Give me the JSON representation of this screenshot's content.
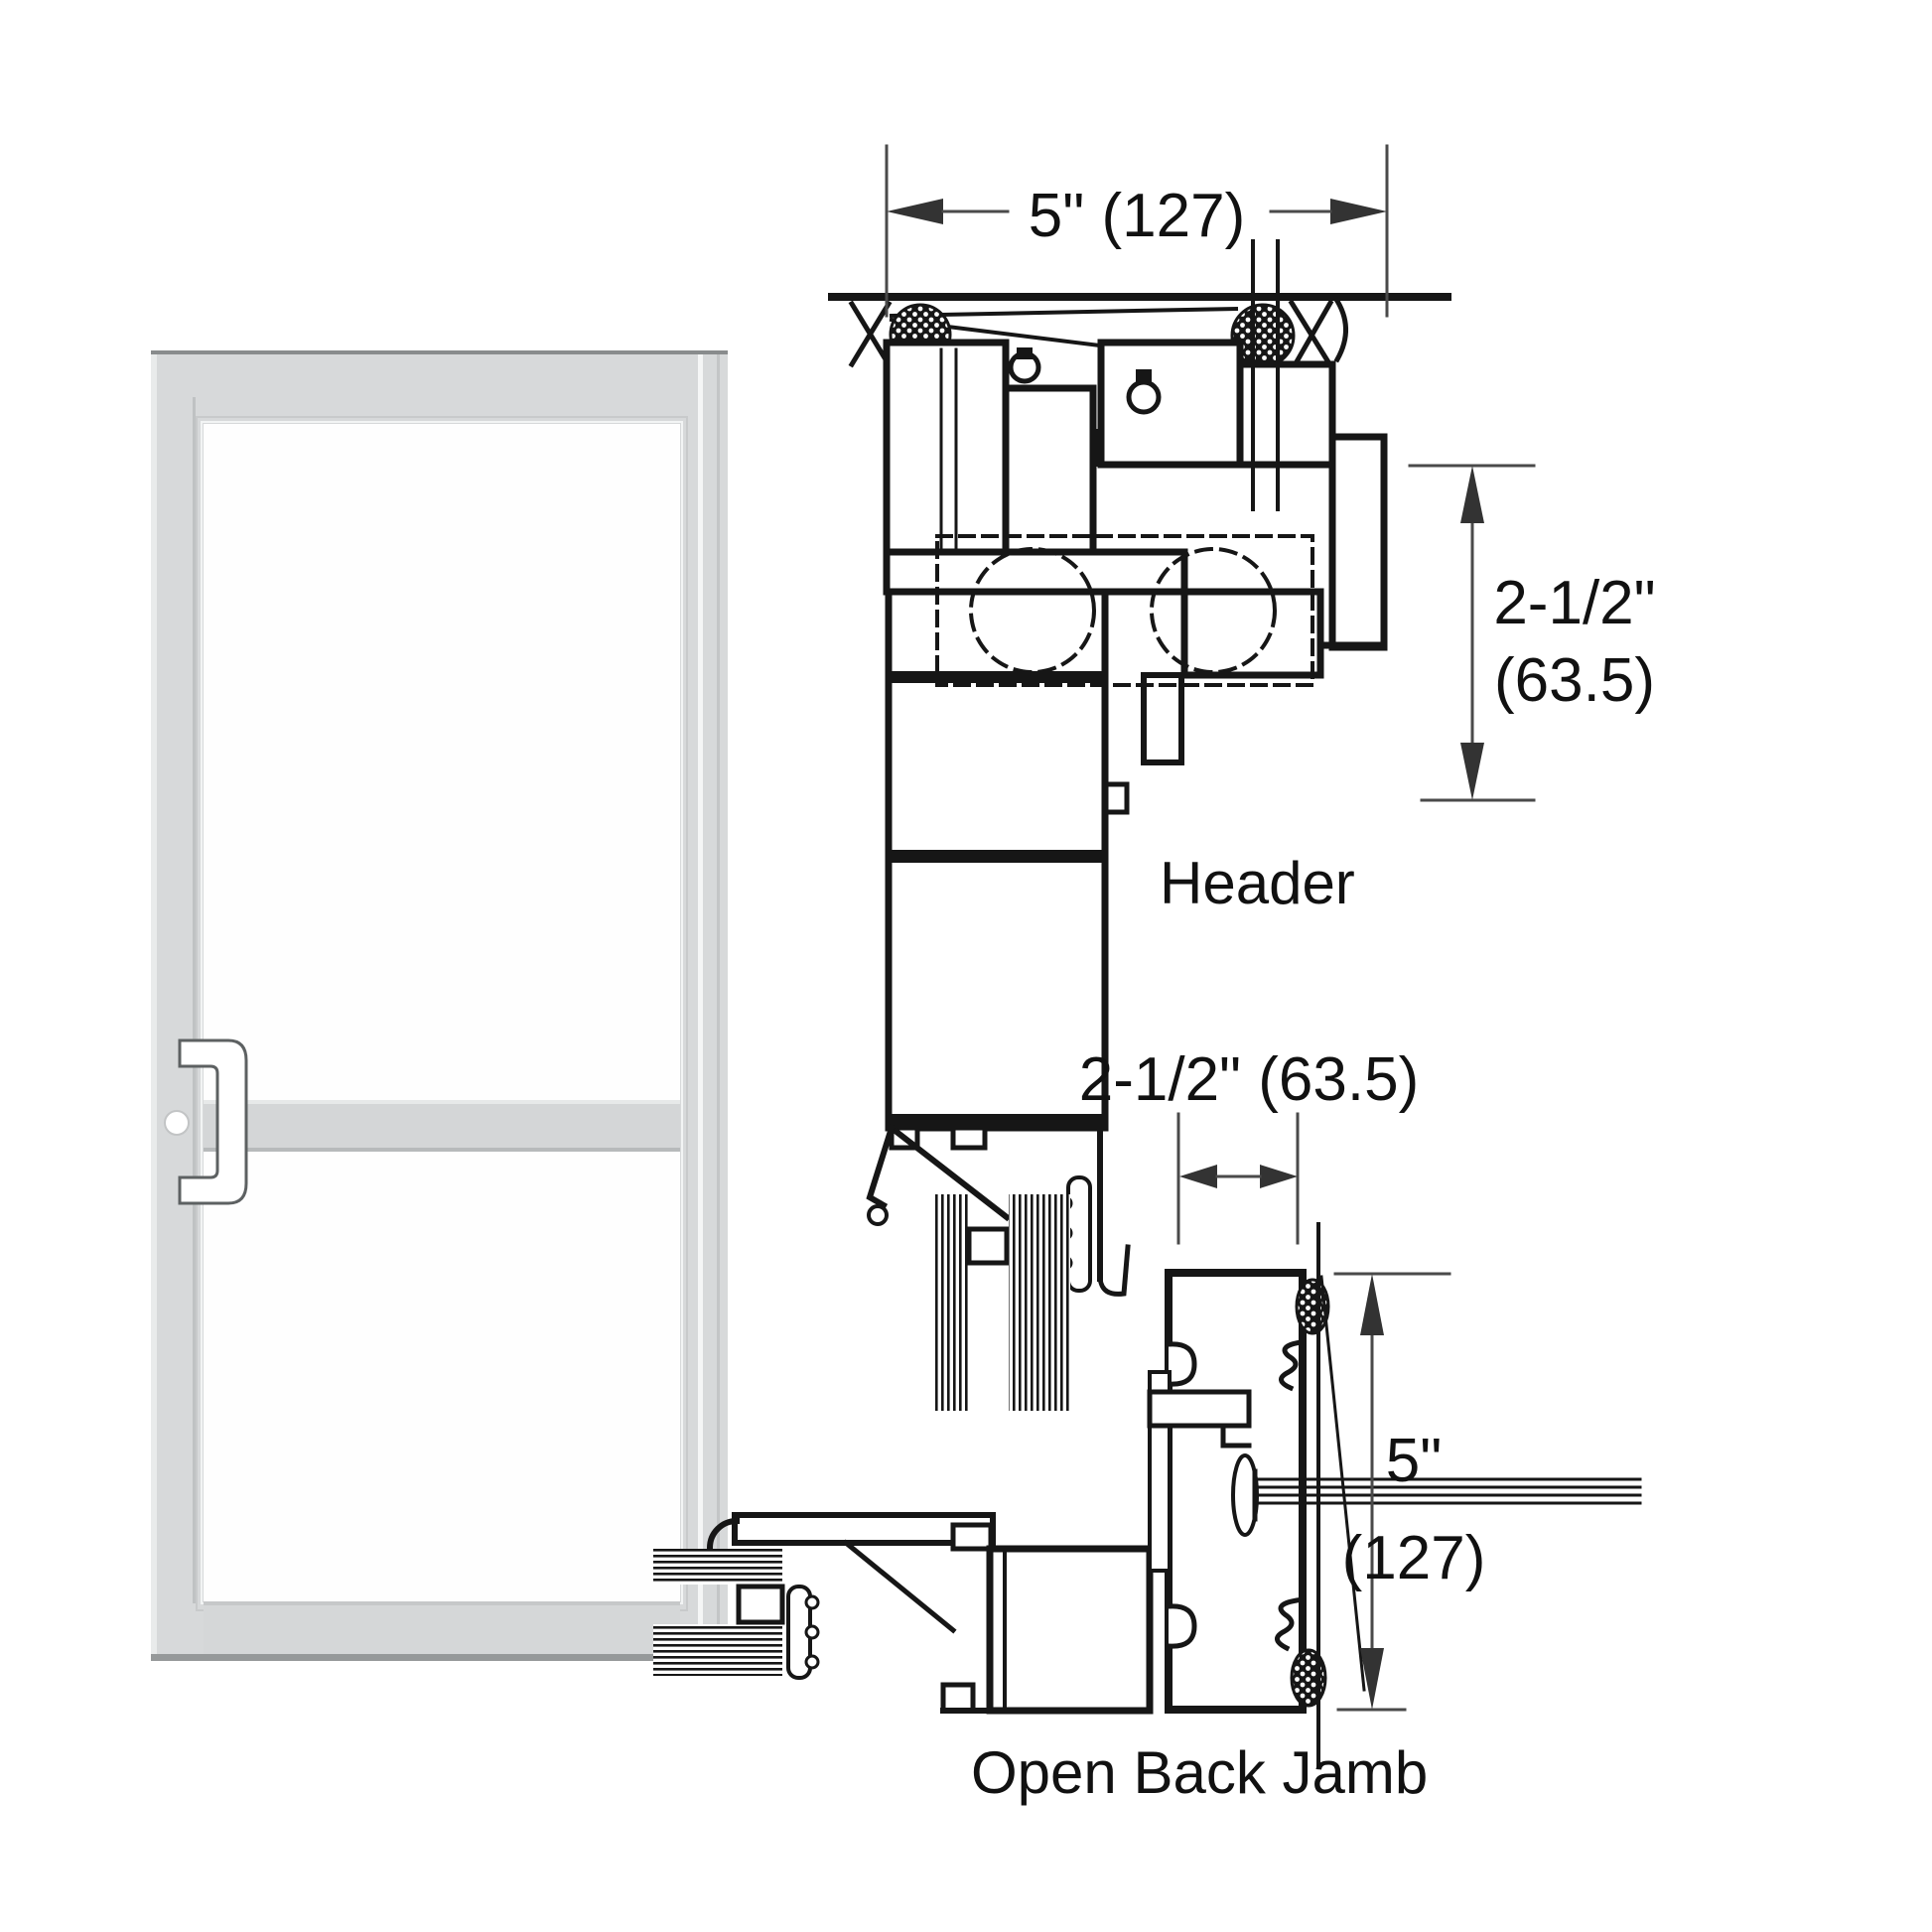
{
  "page": {
    "background": "#ffffff",
    "description_labels_visible": [
      "Header",
      "Open Back Jamb"
    ]
  },
  "colors": {
    "linework": "#161616",
    "dimension_lines": "#4a4a4a",
    "text": "#111111",
    "door_frame_fill": "#d7d9da",
    "door_frame_highlight": "#eaecec",
    "door_frame_shadow": "#b7babb",
    "door_edge_dark": "#8e9192",
    "glass": "#fefefe"
  },
  "sections": {
    "header_detail": {
      "label": "Header",
      "width_dimension": "5\" (127)",
      "depth_dimension": [
        "2-1/2\"",
        "(63.5)"
      ]
    },
    "jamb_detail": {
      "label": "Open Back Jamb",
      "width_dimension": "2-1/2\" (63.5)",
      "depth_dimension": [
        "5\"",
        "(127)"
      ]
    }
  }
}
